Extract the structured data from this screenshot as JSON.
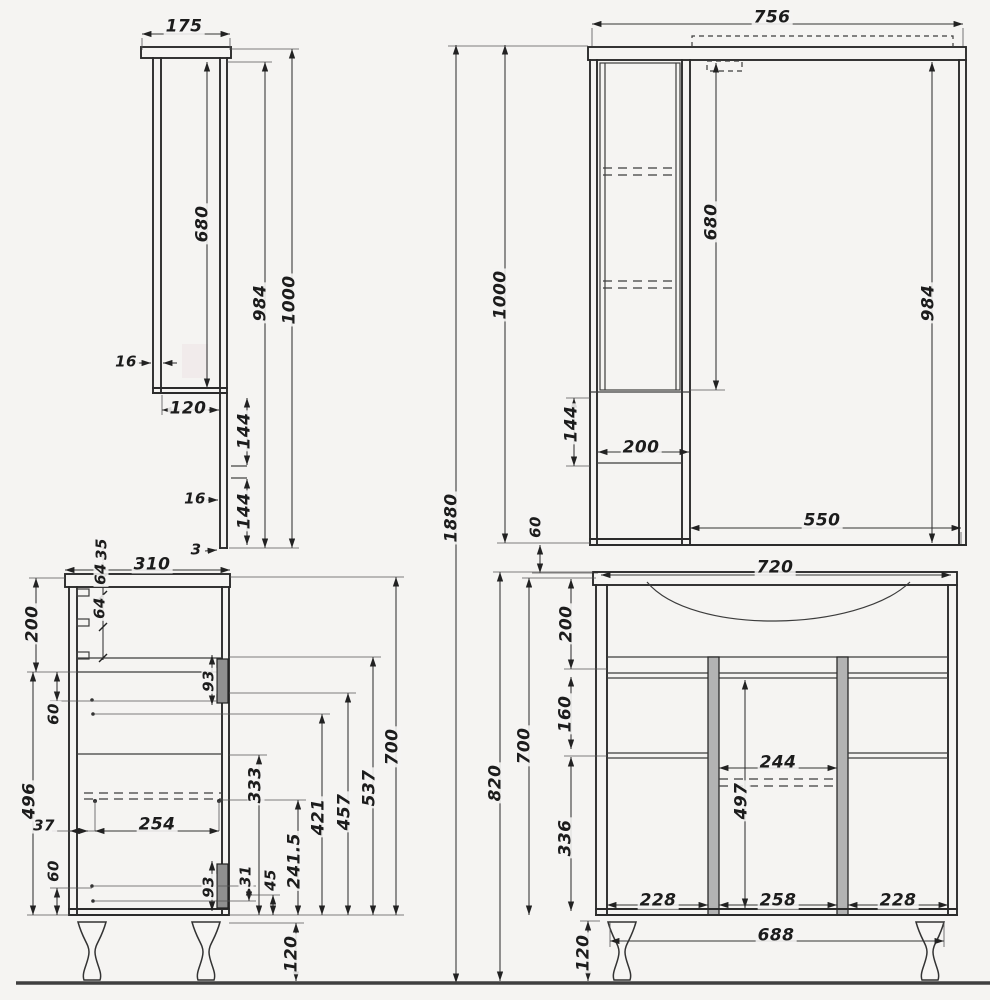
{
  "drawing": {
    "kind": "bathroom furniture dimension drawing",
    "ink_color": "#2b2b2b",
    "background_color": "#f5f4f2",
    "handle_fill": "#8f8f8f",
    "stile_fill": "#b3b3b3"
  },
  "views": {
    "mirror_side": {
      "dims": {
        "top_depth": "175",
        "body_height": "680",
        "panel_height": "984",
        "total_height": "1000",
        "wall_thickness": "16",
        "inner_depth": "120",
        "gap_upper_144": "144",
        "panel_thickness": "16",
        "gap_lower_144": "144",
        "bottom_gap": "3"
      }
    },
    "mirror_front": {
      "dims": {
        "total_width": "756",
        "door_height": "680",
        "panel_height": "984",
        "niche_height": "144",
        "cabinet_width": "200",
        "mirror_width": "550"
      }
    },
    "overall": {
      "dims": {
        "total_height": "1880",
        "upper_height": "1000",
        "gap": "60"
      }
    },
    "vanity_side": {
      "dims": {
        "depth": "310",
        "hinge_offset": "35",
        "hinge_gap1": "64",
        "hinge_gap2": "64",
        "sink_section": "200",
        "gap60_top": "60",
        "lower_height": "496",
        "offset37": "37",
        "gap60_bottom": "60",
        "drawer_depth": "254",
        "handle_top": "93",
        "h333": "333",
        "h421": "421",
        "h457": "457",
        "h537": "537",
        "body_height": "700",
        "off31": "31",
        "off45": "45",
        "h241": "241.5",
        "handle_bottom": "93",
        "leg_height": "120"
      }
    },
    "vanity_front": {
      "dims": {
        "top_width": "720",
        "sink_section": "200",
        "drawer_section": "160",
        "door_section": "336",
        "body_height": "700",
        "total_height": "820",
        "opening_width": "244",
        "inner_height": "497",
        "door_left": "228",
        "drawer_width": "258",
        "door_right": "228",
        "bottom_width": "688",
        "leg_height": "120"
      }
    }
  }
}
